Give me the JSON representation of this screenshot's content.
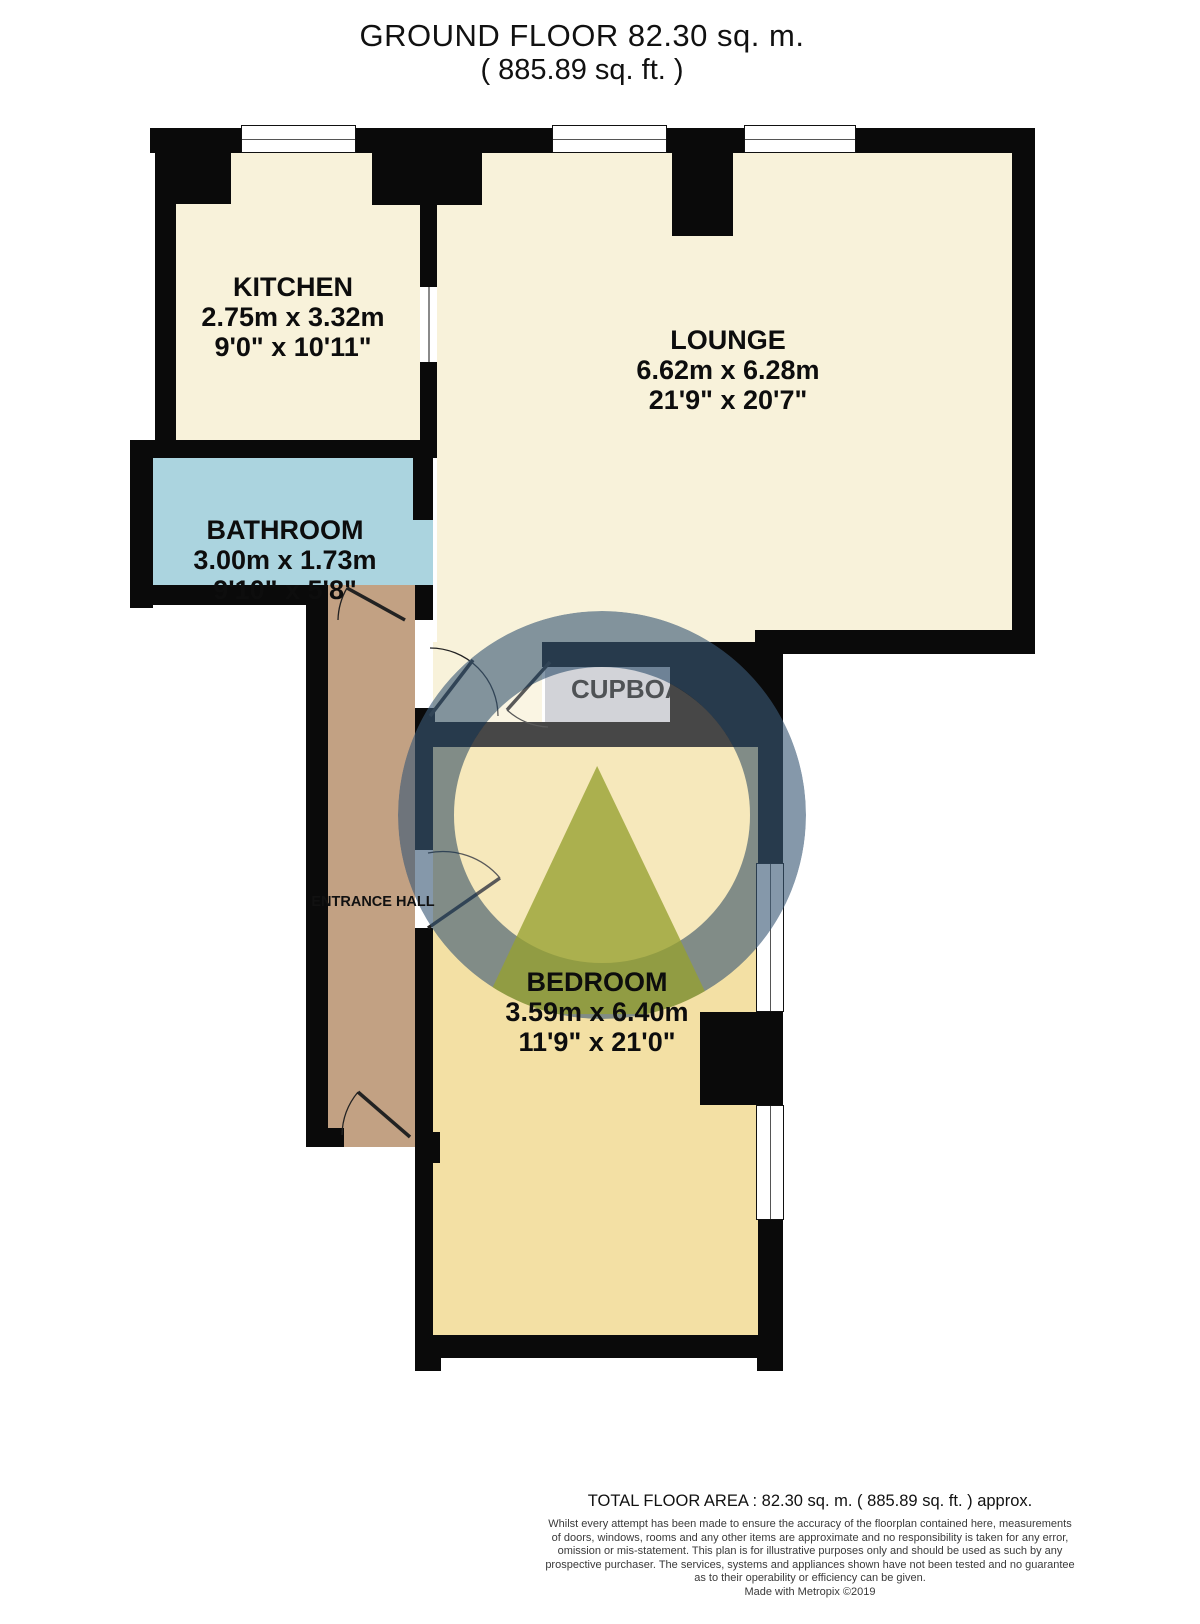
{
  "title": {
    "line1": "GROUND FLOOR 82.30 sq. m.",
    "line2": "( 885.89 sq. ft. )"
  },
  "rooms": {
    "kitchen": {
      "name": "KITCHEN",
      "dim_metric": "2.75m x 3.32m",
      "dim_imperial": "9'0\" x 10'11\""
    },
    "lounge": {
      "name": "LOUNGE",
      "dim_metric": "6.62m x 6.28m",
      "dim_imperial": "21'9\" x 20'7\""
    },
    "bathroom": {
      "name": "BATHROOM",
      "dim_metric": "3.00m x 1.73m",
      "dim_imperial": "9'10\" x 5'8\""
    },
    "bedroom": {
      "name": "BEDROOM",
      "dim_metric": "3.59m x 6.40m",
      "dim_imperial": "11'9\" x 21'0\""
    },
    "entrance_hall": {
      "name": "ENTRANCE HALL"
    },
    "cupboard": {
      "name": "CUPBOARD"
    }
  },
  "footer": {
    "total_area": "TOTAL FLOOR AREA : 82.30 sq. m. ( 885.89 sq. ft. ) approx.",
    "disclaimer_lines": [
      "Whilst every attempt has been made to ensure the accuracy of the floorplan contained here, measurements",
      "of doors, windows, rooms and any other items are approximate and no responsibility is taken for any error,",
      "omission or mis-statement. This plan is for illustrative purposes only and should be used as such by any",
      "prospective purchaser. The services, systems and appliances shown have not been tested and no guarantee",
      "as to their operability or efficiency can be given."
    ],
    "credit": "Made with Metropix ©2019"
  },
  "colors": {
    "wall": "#0a0a0a",
    "room-cream": "#F8F2DA",
    "room-blue": "#ABD4DF",
    "room-tan": "#C2A183",
    "room-gold": "#F3E0A4",
    "room-gray": "#C3C5CB",
    "watermark-ring": "rgba(58,88,118,0.62)",
    "watermark-disc": "rgba(255,255,255,0.25)",
    "watermark-triangle": "rgba(150,160,48,0.78)"
  }
}
